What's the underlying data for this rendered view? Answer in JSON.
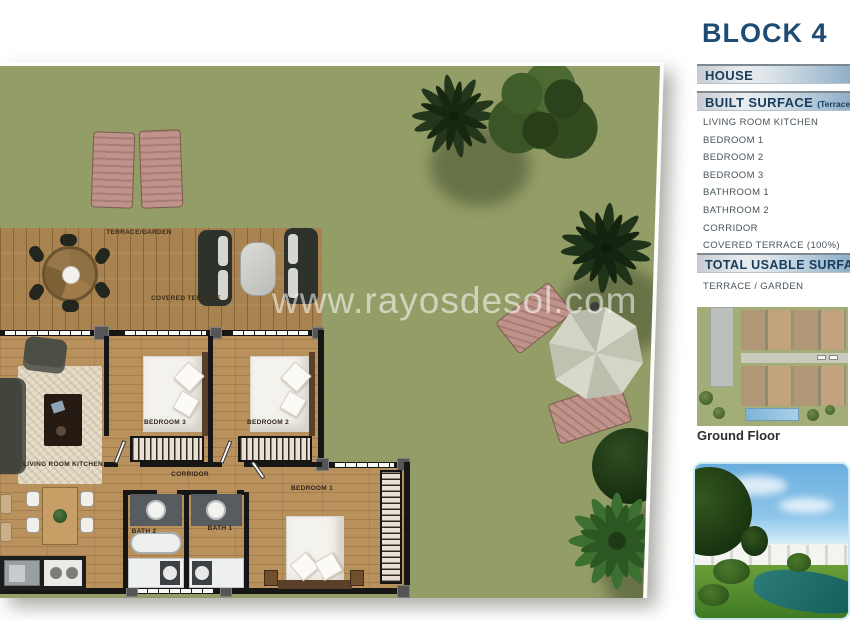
{
  "header": {
    "title": "BLOCK 4"
  },
  "info_panel": {
    "house_label": "HOUSE",
    "built_surface_label": "BUILT SURFACE",
    "built_surface_note": "(Terrace 100%)",
    "rooms": [
      "LIVING ROOM KITCHEN",
      "BEDROOM 1",
      "BEDROOM 2",
      "BEDROOM 3",
      "BATHROOM 1",
      "BATHROOM 2",
      "CORRIDOR",
      "COVERED TERRACE (100%)"
    ],
    "total_usable_label": "TOTAL USABLE SURFACE",
    "terrace_garden_label": "TERRACE / GARDEN",
    "ground_floor_label": "Ground Floor"
  },
  "floor_plan": {
    "watermark": "www.rayosdesol.com",
    "room_labels": {
      "terrace_garden": "TERRACE/GARDEN",
      "covered_terrace": "COVERED TERRACE",
      "living_room_kitchen": "LIVING ROOM KITCHEN",
      "bedroom_3": "BEDROOM 3",
      "bedroom_2": "BEDROOM 2",
      "bedroom_1": "BEDROOM 1",
      "corridor": "CORRIDOR",
      "bath_2": "BATH 2",
      "bath_1": "BATH 1"
    }
  },
  "colors": {
    "accent_navy": "#1e4b72",
    "grass_green": "#939e66",
    "deck_wood": "#a8834f",
    "interior_wood": "#b8915c",
    "photo_border": "#cde7f3"
  }
}
